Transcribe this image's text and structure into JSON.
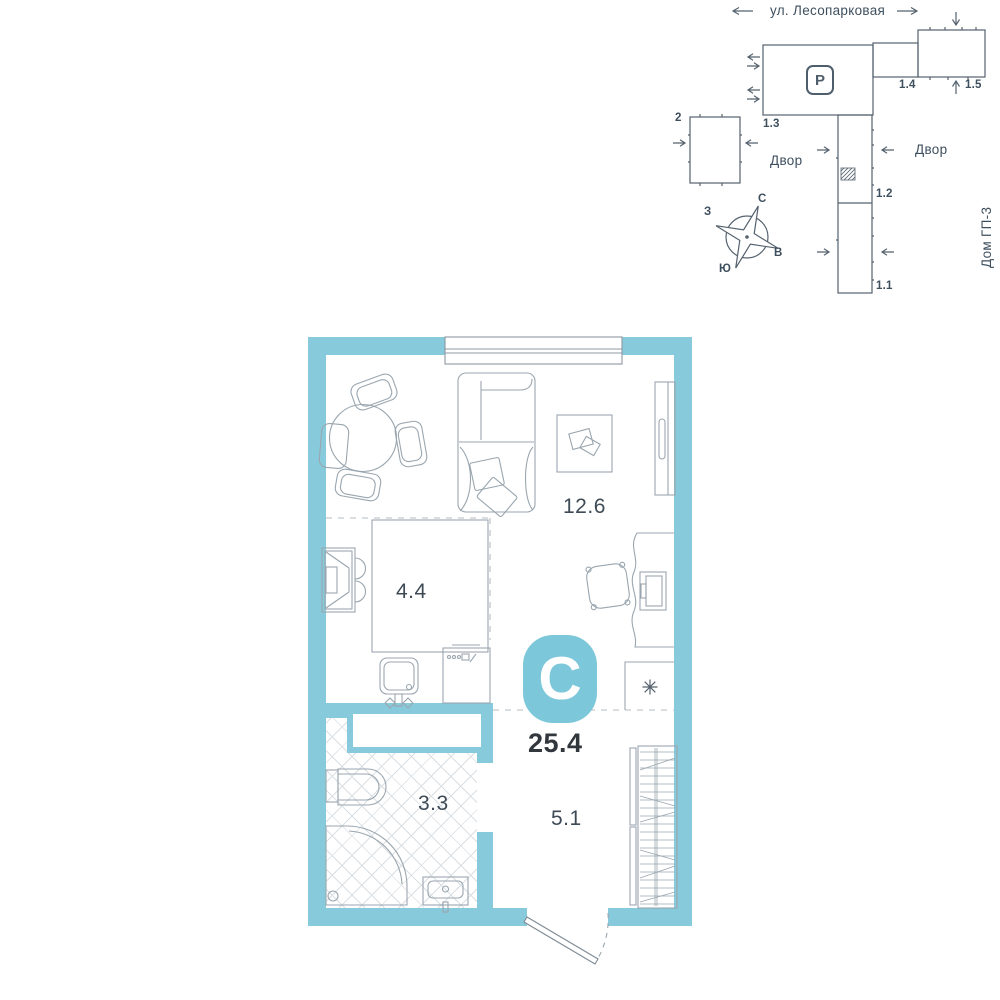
{
  "colors": {
    "wall_teal": "#87CADB",
    "logo_teal": "#7DC7DA",
    "furniture_line": "#9AA6AF",
    "site_line": "#55626E",
    "text": "#3E4F5E",
    "text_strong": "#32373D"
  },
  "site_plan": {
    "street": "ул. Лесопарковая",
    "yard_left": "Двор",
    "yard_right": "Двор",
    "neighbor_house": "Дом ГП-3",
    "parking": "P",
    "buildings": {
      "b2": "2",
      "b1_1": "1.1",
      "b1_2": "1.2",
      "b1_3": "1.3",
      "b1_4": "1.4",
      "b1_5": "1.5"
    },
    "compass": {
      "north": "С",
      "south": "Ю",
      "west": "З",
      "east": "В"
    }
  },
  "plan": {
    "logo_letter": "С",
    "total_area": "25.4",
    "rooms": {
      "living": "12.6",
      "kitchen": "4.4",
      "bathroom": "3.3",
      "hallway": "5.1"
    }
  }
}
